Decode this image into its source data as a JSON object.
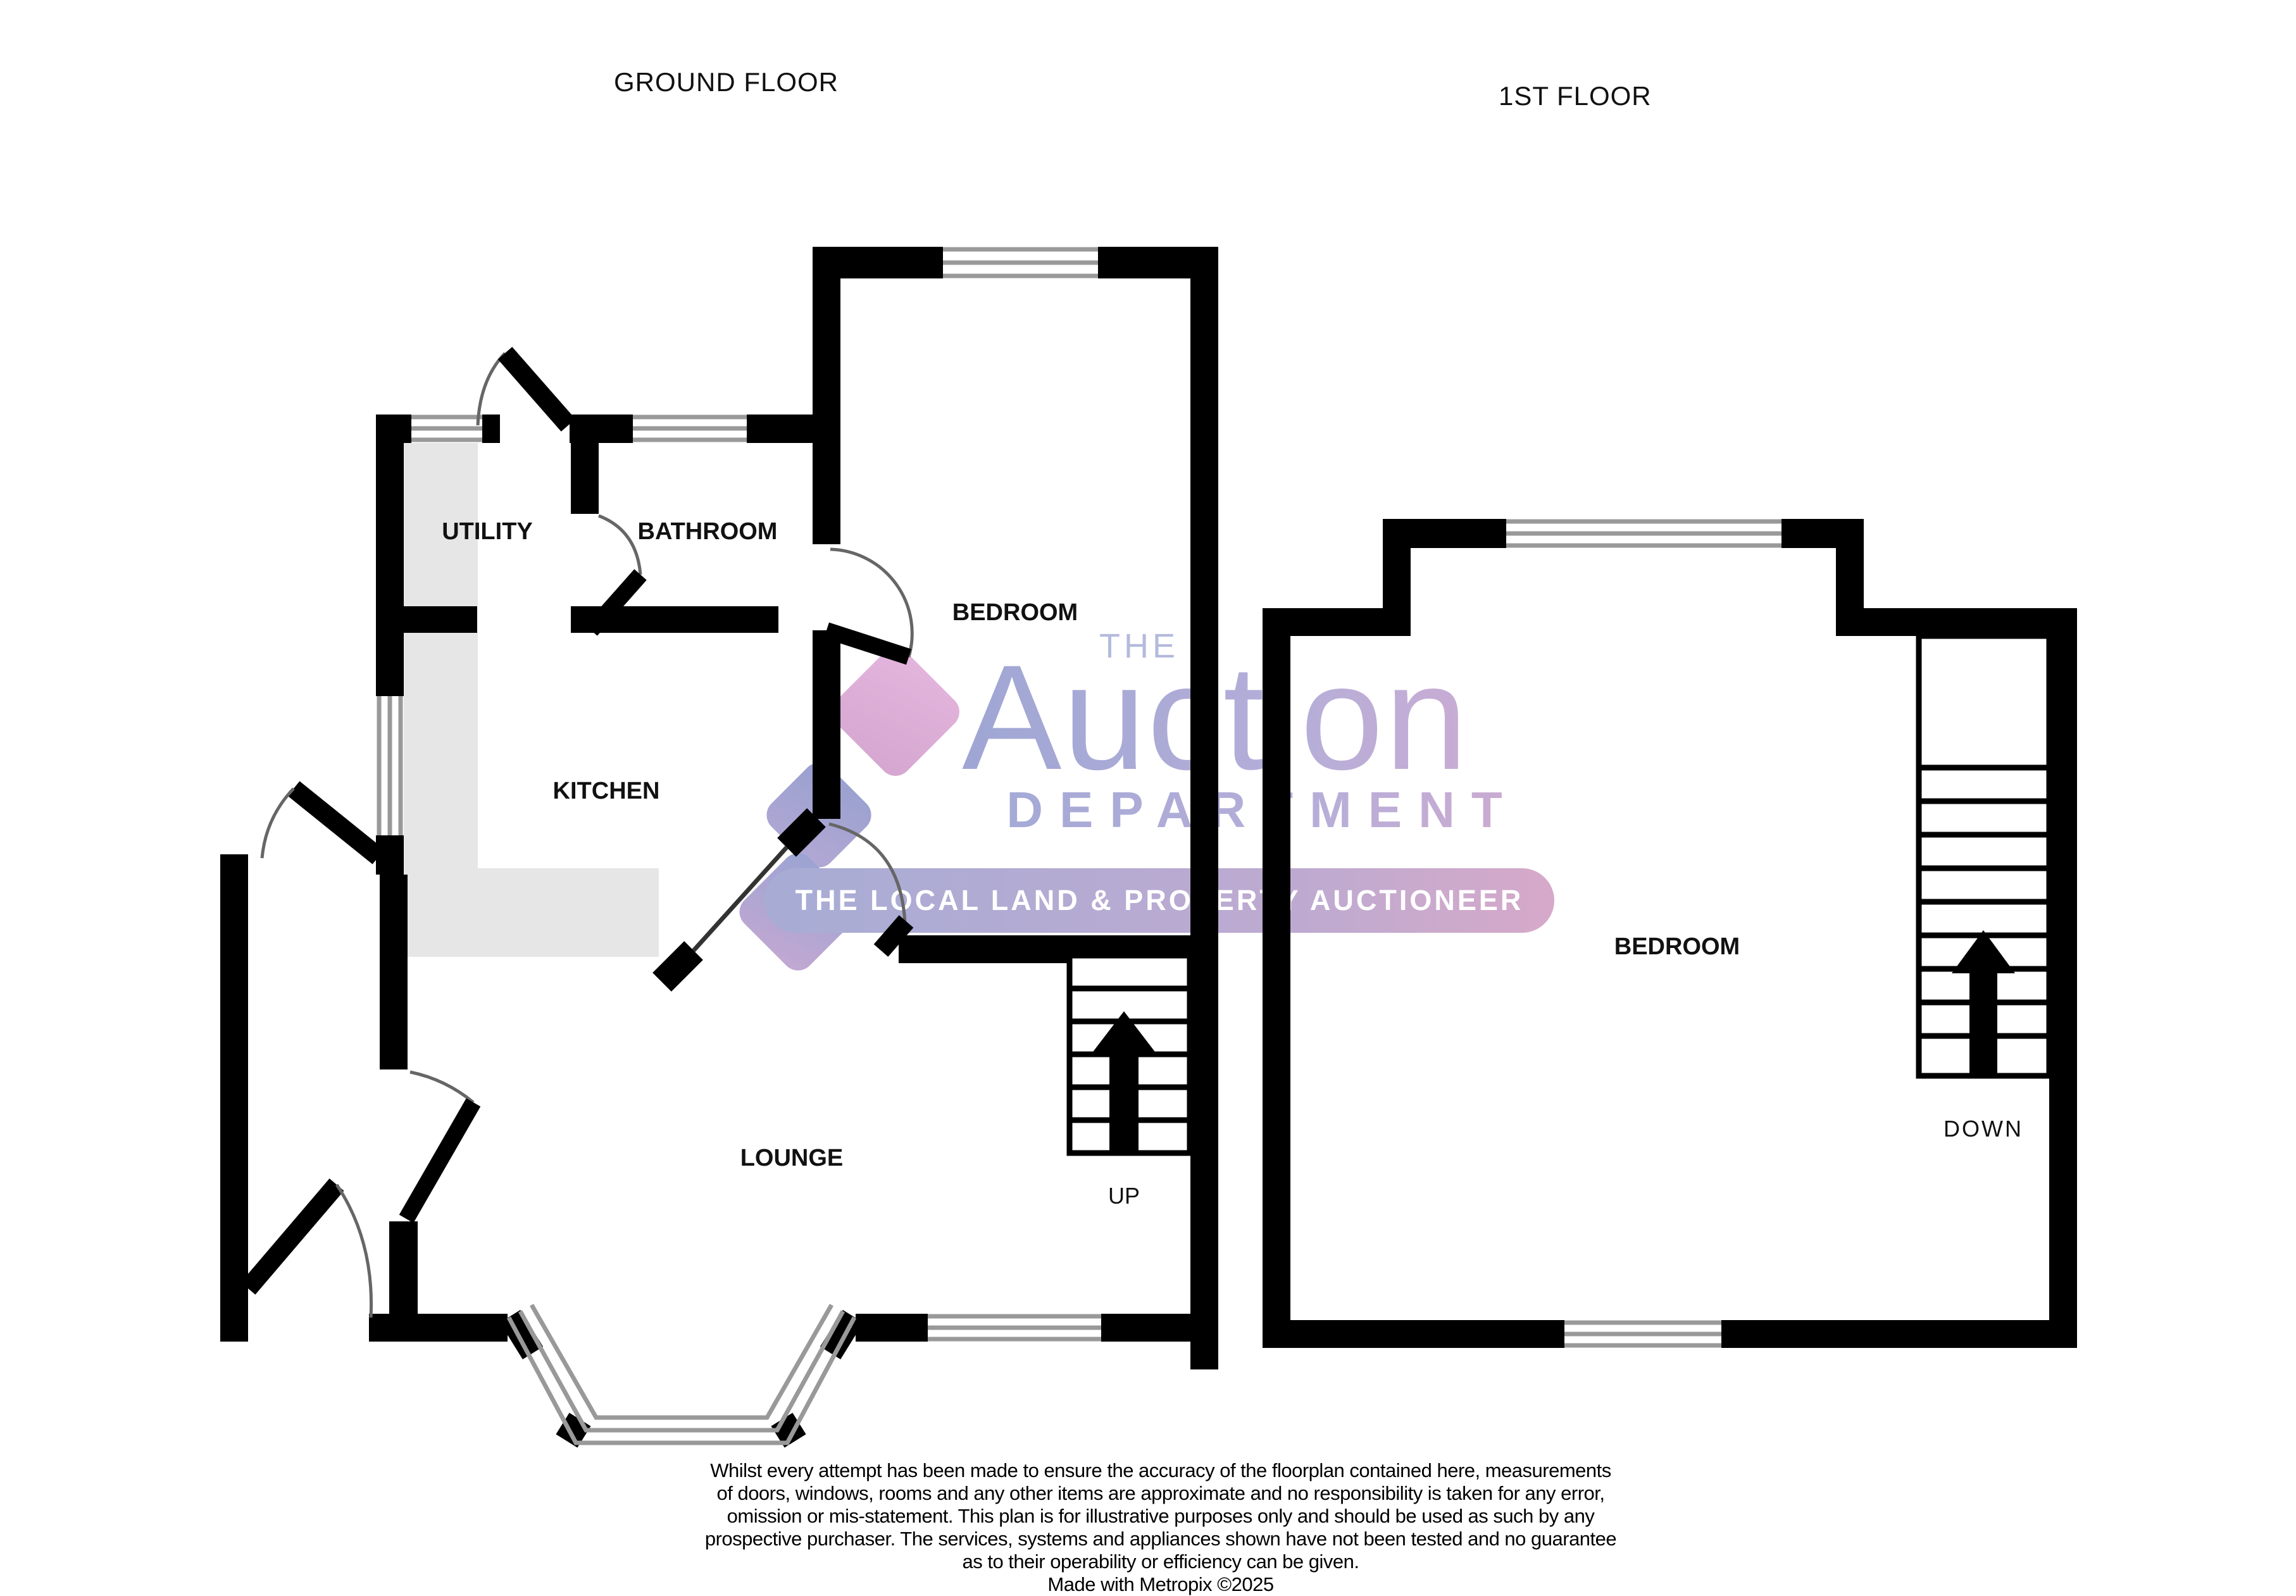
{
  "titles": {
    "ground_floor": "GROUND FLOOR",
    "first_floor": "1ST FLOOR"
  },
  "ground_floor": {
    "rooms": {
      "utility": "UTILITY",
      "bathroom": "BATHROOM",
      "bedroom": "BEDROOM",
      "kitchen": "KITCHEN",
      "lounge": "LOUNGE"
    },
    "stairs_label": "UP"
  },
  "first_floor": {
    "rooms": {
      "bedroom": "BEDROOM"
    },
    "stairs_label": "DOWN"
  },
  "watermark": {
    "the": "THE",
    "auction": "Auction",
    "department": "DEPARTMENT",
    "tagline": "THE LOCAL LAND & PROPERTY AUCTIONEER"
  },
  "disclaimer": {
    "lines": [
      "Whilst every attempt has been made to ensure the accuracy of the floorplan contained here, measurements",
      "of doors, windows, rooms and any other items are approximate and no responsibility is taken for any error,",
      "omission or mis-statement. This plan is for illustrative purposes only and should be used as such by any",
      "prospective purchaser. The services, systems and appliances shown have not been tested and no guarantee",
      "as to their operability or efficiency can be given."
    ],
    "credit": "Made with Metropix ©2025"
  },
  "colors": {
    "wall": "#000000",
    "counter_fill": "#e6e6e6",
    "window_frame": "#999999",
    "door_arc": "#666666",
    "watermark_blue": "#9aa3d2",
    "watermark_pink": "#dfb0da",
    "pill_start": "#a7acd5",
    "pill_end": "#d6a9c9"
  }
}
